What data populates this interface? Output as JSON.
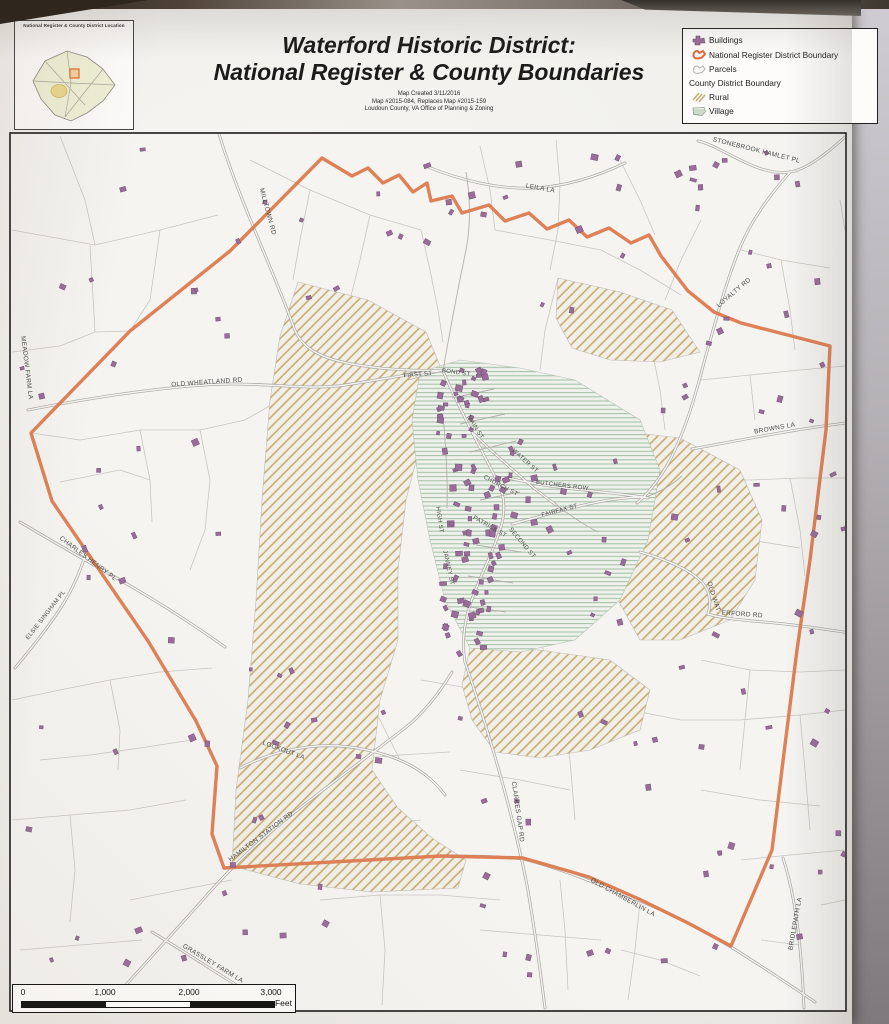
{
  "header": {
    "title_line1": "Waterford Historic District:",
    "title_line2": "National Register & County Boundaries",
    "caption_line1": "Map Created 3/11/2016",
    "caption_line2": "Map #2015-084, Replaces Map #2015-159",
    "caption_line3": "Loudoun County, VA Office of Planning & Zoning",
    "inset_title": "National Register & County District Location"
  },
  "legend": {
    "items": [
      {
        "label": "Buildings",
        "icon": "buildings-icon"
      },
      {
        "label": "National Register District Boundary",
        "icon": "nr-boundary-icon"
      },
      {
        "label": "Parcels",
        "icon": "parcels-icon"
      }
    ],
    "group_label": "County District Boundary",
    "group_items": [
      {
        "label": "Rural",
        "icon": "rural-hatch-icon"
      },
      {
        "label": "Village",
        "icon": "village-hatch-icon"
      }
    ]
  },
  "scalebar": {
    "ticks": [
      "0",
      "1,000",
      "2,000",
      "3,000"
    ],
    "unit": "Feet"
  },
  "colors": {
    "nr_boundary": "#dc7a4e",
    "buildings": "#9a6d99",
    "buildings_stroke": "#73507a",
    "parcel_line": "#c9c6c1",
    "road_casing": "#a5a29d",
    "road_fill": "#f5f4f1",
    "road_minor": "#b3b0ab",
    "rural_line": "#c3a76e",
    "rural_base": "#f2efe6",
    "village_line": "#a2bfa2",
    "village_base": "#eff2ec",
    "map_bg": "#f5f4f1",
    "label_color": "#4a4a48"
  },
  "map": {
    "frame": {
      "x": 10,
      "y": 133,
      "w": 836,
      "h": 878
    },
    "nr_boundary_path": "M322 158 L352 176 L368 168 L383 183 L399 175 L413 192 L427 183 L431 201 L452 196 L462 213 L489 205 L505 221 L529 213 L547 229 L569 220 L587 237 L609 228 L631 243 L649 235 L661 256 L688 291 L714 312 L741 323 L830 346 L826 430 L810 560 L797 650 L785 745 L772 850 L731 946 L688 923 L639 899 L589 877 L523 858 L441 856 L224 868 L212 834 L217 766 L196 721 L148 641 L52 501 L31 433 L130 331 L230 251 Z",
    "rural_polys": [
      "M298 282 L368 300 L426 332 L441 368 L424 430 L406 500 L398 570 L398 640 L380 700 L372 770 L398 808 L432 838 L466 860 L458 888 L372 892 L300 884 L232 866 L236 790 L248 700 L256 600 L262 500 L270 400 L280 336 Z",
      "M558 278 L620 292 L672 310 L700 352 L660 362 L610 360 L572 348 L556 318 Z",
      "M610 430 L680 438 L740 470 L762 520 L755 580 L730 620 L680 640 L640 640 L618 600 L608 520 Z",
      "M470 648 L540 650 L610 660 L650 690 L640 730 L590 750 L540 758 L495 752 L472 720 L462 685 Z"
    ],
    "village_poly": "M420 372 L460 360 L520 368 L575 380 L640 420 L660 470 L648 540 L620 600 L575 640 L520 652 L470 648 L445 600 L430 540 L418 480 L412 420 Z",
    "roads_major": [
      "M28 410 C100 396 160 388 205 385 C260 381 305 391 345 385 C390 378 420 372 443 371",
      "M219 134 C230 170 244 205 258 238 C272 272 284 300 293 325 C300 348 320 358 352 364 C390 371 420 370 443 371",
      "M428 167 C460 180 500 190 535 188 C570 186 600 175 625 163",
      "M845 137 C822 158 804 170 790 172 C757 177 722 146 698 141",
      "M790 172 C770 195 751 220 739 250 C726 282 716 320 706 355 C697 390 686 430 669 462 C656 485 646 495 637 503",
      "M692 449 C730 442 770 434 810 428 C835 424 862 421 880 419",
      "M640 552 C668 560 690 570 702 582 C711 592 711 605 708 614 C720 618 740 620 764 622 C800 625 845 632 880 638",
      "M508 478 C530 483 552 487 575 489 C600 492 625 494 648 498",
      "M512 524 C535 518 558 511 580 506 C600 501 625 497 646 497",
      "M443 371 C452 392 462 412 472 432 C482 452 492 470 500 487 C505 500 505 515 500 530 C492 555 478 580 470 605 C463 627 462 645 465 662",
      "M465 662 C478 700 492 745 503 785 C512 818 520 850 527 885 C534 925 540 968 545 1008",
      "M96 1018 C130 980 165 942 200 903 C230 868 262 838 295 812 C330 784 370 755 405 728 C425 712 440 692 452 672",
      "M438 856 C470 856 500 856 523 859 C560 868 600 885 640 901 C675 915 705 932 731 947 C760 965 790 985 815 1002",
      "M20 522 C50 540 85 560 120 580 C155 600 190 622 225 647",
      "M240 768 C265 755 290 748 318 746 C350 744 385 752 410 765 C425 773 438 785 445 795",
      "M152 932 C185 952 220 975 252 995 C270 1006 285 1015 295 1022",
      "M783 858 C790 880 795 905 798 930 C801 955 803 982 804 1008",
      "M472 432 C488 448 505 463 520 476 C532 487 545 497 556 505",
      "M15 668 C30 650 48 628 62 606 C72 590 80 572 85 556"
    ],
    "roads_minor": [
      "M452 398 L494 389",
      "M460 424 L505 414",
      "M470 452 L516 441",
      "M480 500 L520 492",
      "M476 545 L521 552",
      "M468 576 L513 583",
      "M462 606 L506 612",
      "M443 415 C446 448 448 478 447 508",
      "M408 380 L443 371",
      "M443 371 C450 330 458 288 466 250 C471 224 470 196 466 172",
      "M556 505 C570 515 584 525 598 532",
      "M646 497 C660 492 672 485 682 476"
    ],
    "parcel_paths": [
      "M12 230 L95 245 L160 230 L218 215",
      "M60 136 L85 200 L95 245",
      "M160 230 L150 300 L130 331",
      "M12 352 L60 346 L95 332 L130 331",
      "M95 332 L90 245",
      "M31 433 L80 440 L140 430 L200 430 L245 420 L280 400 L312 394",
      "M140 430 L150 480 L152 522",
      "M60 482 L120 470 L150 480",
      "M200 430 L210 480 L205 530 L190 570",
      "M12 700 L60 690 L110 680 L160 672 L212 668",
      "M110 680 L120 730 L118 770",
      "M40 760 L90 755 L140 748 L192 740",
      "M12 820 L70 815 L130 810 L186 800",
      "M70 815 L75 870 L70 922",
      "M130 900 L180 890 L232 880",
      "M20 950 L80 945 L142 940",
      "M250 160 L310 190 L370 215 L421 230",
      "M370 215 L360 260 L350 300",
      "M421 230 L430 270 L438 310 L443 342",
      "M310 190 L300 240 L293 280",
      "M480 146 L490 190 L495 230",
      "M556 140 L560 185 L558 230 L550 270",
      "M495 230 L550 240 L601 250",
      "M601 250 L640 270 L681 295",
      "M620 160 L640 200 L655 235",
      "M701 220 L681 260 L665 300",
      "M741 250 L781 260 L830 268",
      "M781 260 L790 310 L795 350",
      "M840 200 L850 260 L852 320",
      "M701 380 L750 375 L800 370 L845 366",
      "M750 375 L755 420",
      "M701 480 L750 480 L800 478 L845 478",
      "M790 478 L800 530 L805 576",
      "M701 530 L750 540 L800 548",
      "M701 660 L750 670 L800 672 L845 670",
      "M750 670 L745 720 L740 770",
      "M681 720 L740 720 L800 715 L845 710",
      "M800 715 L805 770 L810 830",
      "M701 790 L760 800 L820 806",
      "M741 860 L790 855 L845 850",
      "M821 905 L845 900",
      "M761 940 L800 945",
      "M320 900 L380 895 L440 895 L500 900",
      "M380 895 L385 950 L382 1005",
      "M480 930 L540 935 L601 940",
      "M560 880 L565 930 L568 990",
      "M621 950 L660 960 L700 976",
      "M640 901 L635 950 L628 1000",
      "M300 830 L360 825 L421 820",
      "M340 760 L400 755 L450 752",
      "M421 680 L480 690",
      "M350 680 L380 720 L400 760",
      "M540 640 L560 700 L570 760 L575 820",
      "M575 700 L630 710 L681 720",
      "M460 770 L520 780 L570 790",
      "M650 340 L660 390 L665 430",
      "M558 278 L545 330 L540 370"
    ],
    "building_clusters": [
      {
        "x": 436,
        "y": 362,
        "w": 48,
        "h": 100,
        "n": 30
      },
      {
        "x": 446,
        "y": 462,
        "w": 56,
        "h": 100,
        "n": 32
      },
      {
        "x": 438,
        "y": 562,
        "w": 52,
        "h": 95,
        "n": 26
      },
      {
        "x": 500,
        "y": 420,
        "w": 70,
        "h": 120,
        "n": 12
      },
      {
        "x": 20,
        "y": 140,
        "w": 380,
        "h": 160,
        "n": 14
      },
      {
        "x": 20,
        "y": 310,
        "w": 230,
        "h": 300,
        "n": 14
      },
      {
        "x": 20,
        "y": 620,
        "w": 280,
        "h": 360,
        "n": 22
      },
      {
        "x": 420,
        "y": 140,
        "w": 220,
        "h": 170,
        "n": 15
      },
      {
        "x": 650,
        "y": 140,
        "w": 195,
        "h": 300,
        "n": 24
      },
      {
        "x": 650,
        "y": 450,
        "w": 195,
        "h": 260,
        "n": 14
      },
      {
        "x": 560,
        "y": 680,
        "w": 285,
        "h": 300,
        "n": 22
      },
      {
        "x": 300,
        "y": 690,
        "w": 240,
        "h": 290,
        "n": 15
      },
      {
        "x": 560,
        "y": 450,
        "w": 80,
        "h": 200,
        "n": 9
      }
    ],
    "road_labels": [
      {
        "t": "MILLTOWN RD",
        "x": 266,
        "y": 212,
        "r": 75,
        "s": 6.5
      },
      {
        "t": "LEILA LA",
        "x": 540,
        "y": 190,
        "r": 10,
        "s": 6.5
      },
      {
        "t": "STONEBROOK HAMLET PL",
        "x": 756,
        "y": 152,
        "r": 14,
        "s": 6.5
      },
      {
        "t": "LOYALTY RD",
        "x": 735,
        "y": 294,
        "r": -40,
        "s": 6.5
      },
      {
        "t": "MEADOW FARM LA",
        "x": 25,
        "y": 368,
        "r": 83,
        "s": 6.5
      },
      {
        "t": "OLD WHEATLAND RD",
        "x": 207,
        "y": 384,
        "r": -4,
        "s": 6.5
      },
      {
        "t": "BROWNS LA",
        "x": 775,
        "y": 430,
        "r": -10,
        "s": 6.5
      },
      {
        "t": "CHARLES HENRY PL",
        "x": 87,
        "y": 560,
        "r": 37,
        "s": 6.5
      },
      {
        "t": "ELSIE SINGHAM PL",
        "x": 47,
        "y": 616,
        "r": -52,
        "s": 6
      },
      {
        "t": "OLD WAT",
        "x": 712,
        "y": 597,
        "r": 72,
        "s": 6.5
      },
      {
        "t": "ERFORD RD",
        "x": 742,
        "y": 616,
        "r": 4,
        "s": 6.5
      },
      {
        "t": "BUTCHERS ROW",
        "x": 562,
        "y": 487,
        "r": 7,
        "s": 6
      },
      {
        "t": "FAIRFAX ST",
        "x": 560,
        "y": 512,
        "r": -15,
        "s": 6
      },
      {
        "t": "WATER ST",
        "x": 524,
        "y": 462,
        "r": 42,
        "s": 6
      },
      {
        "t": "MAIN ST",
        "x": 474,
        "y": 428,
        "r": 58,
        "s": 6
      },
      {
        "t": "CHURCH ST",
        "x": 500,
        "y": 487,
        "r": 28,
        "s": 6
      },
      {
        "t": "BOND ST",
        "x": 456,
        "y": 374,
        "r": 8,
        "s": 6
      },
      {
        "t": "FIRST ST",
        "x": 418,
        "y": 376,
        "r": -5,
        "s": 6
      },
      {
        "t": "JANNEY ST",
        "x": 447,
        "y": 568,
        "r": 78,
        "s": 6
      },
      {
        "t": "SECOND ST",
        "x": 521,
        "y": 544,
        "r": 50,
        "s": 6
      },
      {
        "t": "HIGH ST",
        "x": 438,
        "y": 520,
        "r": 82,
        "s": 6
      },
      {
        "t": "PATRICK ST",
        "x": 489,
        "y": 528,
        "r": 30,
        "s": 6
      },
      {
        "t": "CLARKES GAP RD",
        "x": 516,
        "y": 812,
        "r": 82,
        "s": 6.5
      },
      {
        "t": "OLD CHAMBERLIN LA",
        "x": 622,
        "y": 899,
        "r": 29,
        "s": 6.5
      },
      {
        "t": "HAMILTON STATION RD",
        "x": 262,
        "y": 838,
        "r": -37,
        "s": 6.5
      },
      {
        "t": "LOOKOUT LA",
        "x": 283,
        "y": 752,
        "r": 20,
        "s": 6.5
      },
      {
        "t": "GRASSLEY FARM LA",
        "x": 212,
        "y": 965,
        "r": 31,
        "s": 6.5
      },
      {
        "t": "BRIDLEPATH LA",
        "x": 797,
        "y": 924,
        "r": -80,
        "s": 6.5
      }
    ]
  }
}
